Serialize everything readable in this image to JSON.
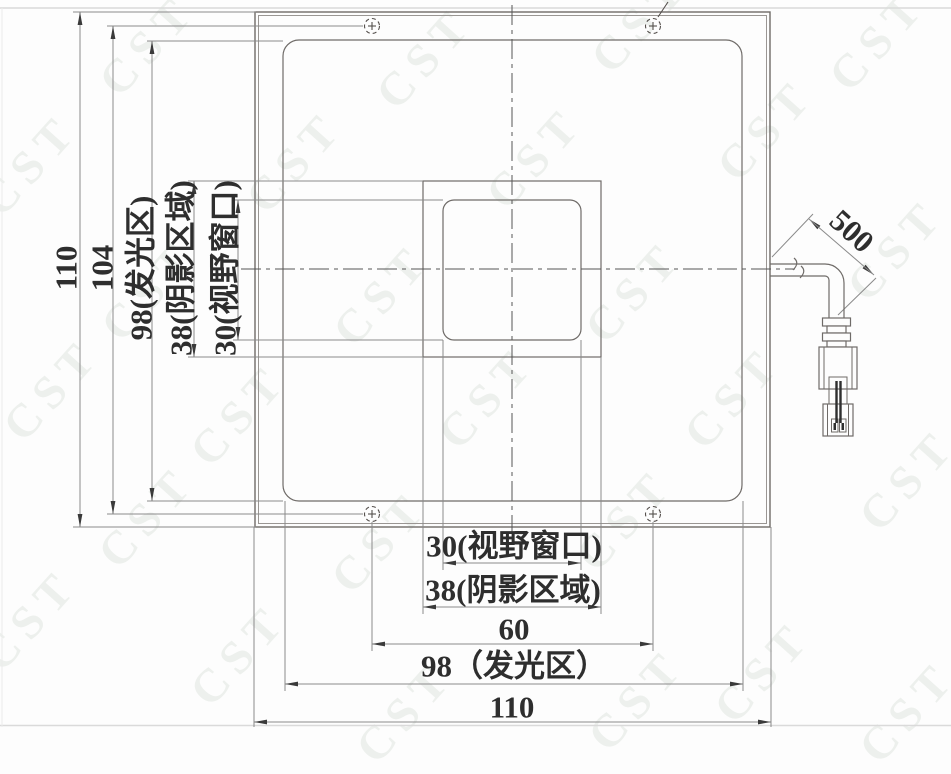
{
  "watermark": {
    "text": "CST"
  },
  "left_dimensions": {
    "overall": "110",
    "mount_holes": "104",
    "light_area": "98(发光区)",
    "shadow_area": "38(阴影区域)",
    "view_window": "30(视野窗口)"
  },
  "bottom_dimensions": {
    "view_window": "30(视野窗口)",
    "shadow_area": "38(阴影区域)",
    "mount_holes": "60",
    "light_area": "98（发光区）",
    "overall": "110"
  },
  "cable": {
    "length_dimension": "500"
  },
  "colors": {
    "outline_line": "#6f6b68",
    "dimension_line": "#8a8a8a",
    "text": "#2e2e2e",
    "watermark": "#eef1ee",
    "page_rule": "#dadada"
  }
}
